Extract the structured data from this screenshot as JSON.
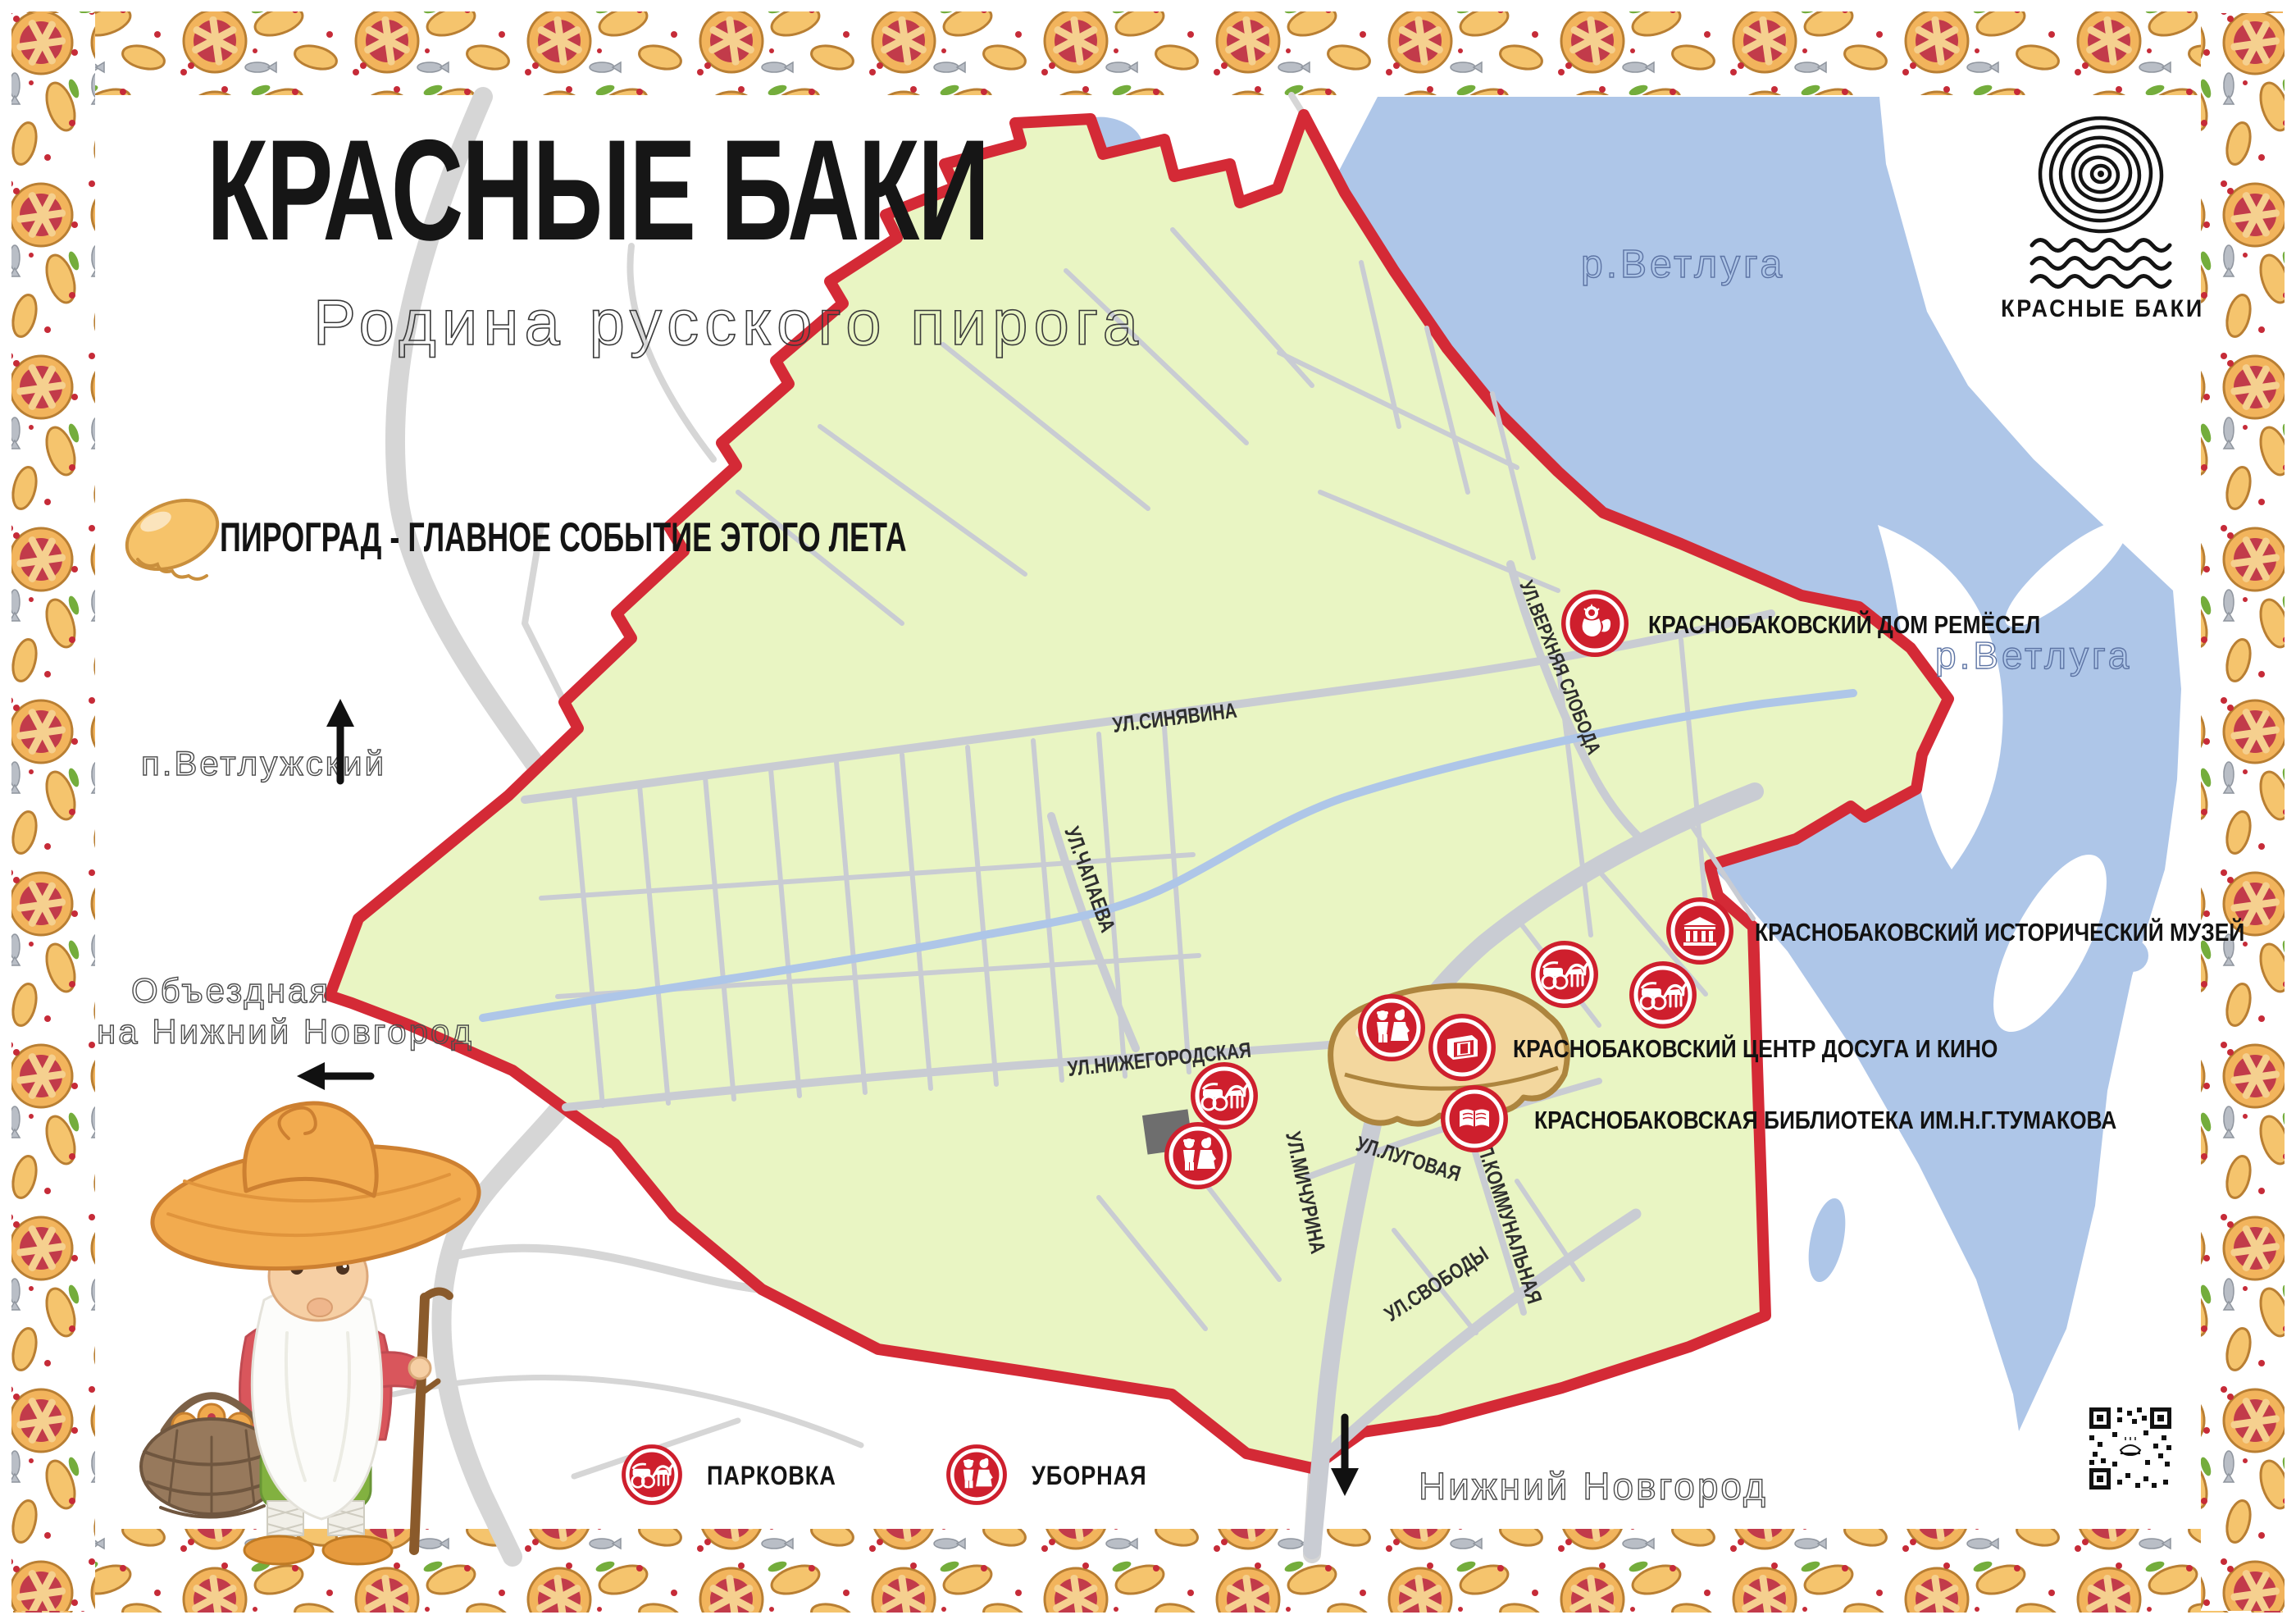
{
  "header": {
    "title": "КРАСНЫЕ БАКИ",
    "subtitle": "Родина русского пирога",
    "tagline": "ПИРОГРАД  - ГЛАВНОЕ СОБЫТИЕ ЭТОГО ЛЕТА"
  },
  "logo": {
    "label": "КРАСНЫЕ БАКИ"
  },
  "map": {
    "rivers": {
      "top": "р.Ветлуга",
      "east": "р.Ветлуга"
    },
    "directions": {
      "north": "п.Ветлужский",
      "west_line1": "Объездная",
      "west_line2": "на Нижний Новгород",
      "south": "Нижний Новгород"
    },
    "streets": [
      {
        "label": "УЛ.ВЕРХНЯЯ СЛОБОДА"
      },
      {
        "label": "УЛ.СИНЯВИНА"
      },
      {
        "label": "УЛ.ЧАПАЕВА"
      },
      {
        "label": "УЛ.НИЖЕГОРОДСКАЯ"
      },
      {
        "label": "УЛ.МИЧУРИНА"
      },
      {
        "label": "УЛ.ЛУГОВАЯ"
      },
      {
        "label": "УЛ.КОММУНАЛЬНАЯ"
      },
      {
        "label": "УЛ.СВОБОДЫ"
      }
    ],
    "pois": [
      {
        "label": "КРАСНОБАКОВСКИЙ ДОМ РЕМЁСЕЛ",
        "icon": "folk-doll-icon"
      },
      {
        "label": "КРАСНОБАКОВСКИЙ ИСТОРИЧЕСКИЙ МУЗЕЙ",
        "icon": "museum-icon"
      },
      {
        "label": "КРАСНОБАКОВСКИЙ ЦЕНТР ДОСУГА И КИНО",
        "icon": "cinema-building-icon"
      },
      {
        "label": "КРАСНОБАКОВСКАЯ БИБЛИОТЕКА ИМ.Н.Г.ТУМАКОВА",
        "icon": "open-book-icon"
      }
    ]
  },
  "legend": {
    "parking": "ПАРКОВКА",
    "toilet": "УБОРНАЯ"
  },
  "colors": {
    "accent_red": "#d42a36",
    "marker_red": "#ce1f2d",
    "town_fill": "#e9f5c3",
    "river_blue": "#aec6e8",
    "road_gray": "#d6d6d6"
  }
}
